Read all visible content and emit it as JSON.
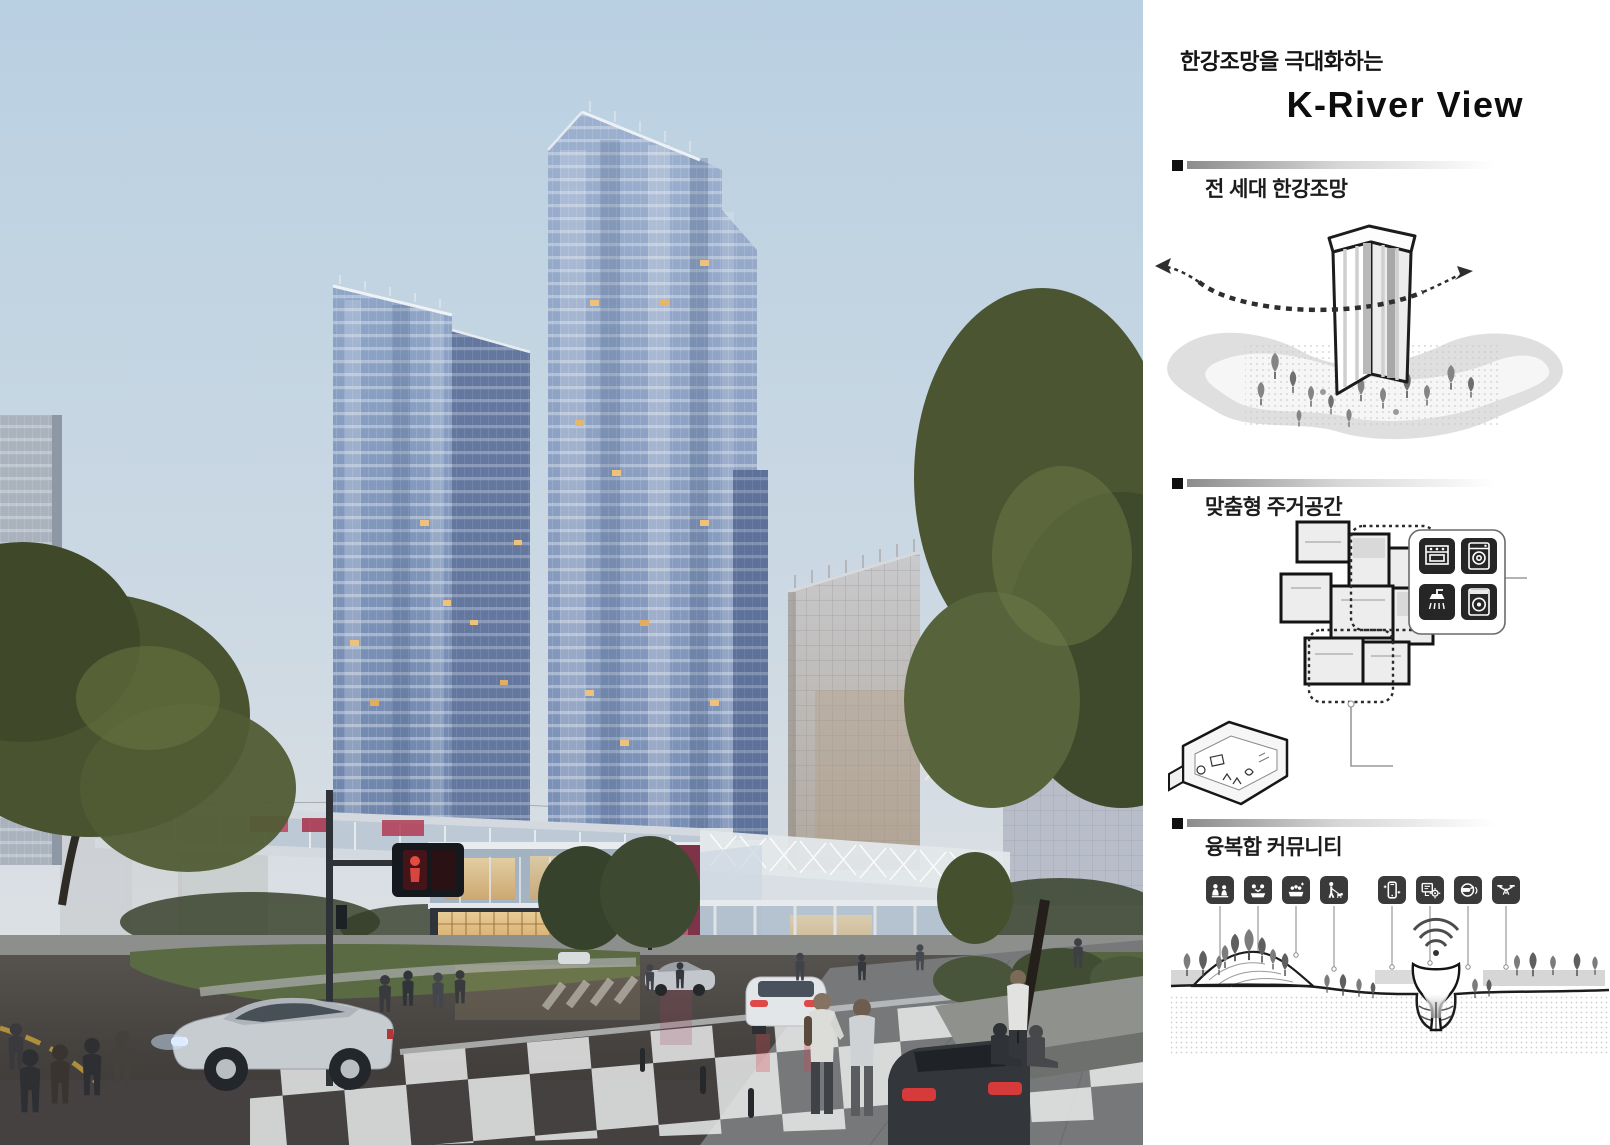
{
  "panel": {
    "header": {
      "subtitle": "한강조망을 극대화하는",
      "title": "K-River View"
    },
    "sections": [
      {
        "id": "river-view",
        "heading": "전 세대 한강조망"
      },
      {
        "id": "custom-residential",
        "heading": "맞춤형 주거공간"
      },
      {
        "id": "mixed-community",
        "heading": "융복합 커뮤니티"
      }
    ],
    "appliance_icons": [
      "kitchen-range-icon",
      "washing-machine-icon",
      "shower-icon",
      "dryer-icon"
    ],
    "community_icons": [
      "family-care-icon",
      "group-meeting-icon",
      "water-leisure-icon",
      "pet-walking-icon",
      "smartphone-icon",
      "smart-control-icon",
      "vr-headset-icon",
      "drone-icon"
    ]
  },
  "palette": {
    "sky_top": "#b9d0e2",
    "sky_bottom": "#e4e5e6",
    "tower_glass": "#7e95bb",
    "office_facade": "#bcbcc0",
    "warm_light": "#e2b873",
    "road": "#4a4643",
    "lawn": "#5a6a42",
    "tree": "#46512f",
    "signal_red": "#e04b3e",
    "text": "#141414",
    "icon_background": "#3a3a3a",
    "diagram_gray": "#d6d6d6"
  }
}
